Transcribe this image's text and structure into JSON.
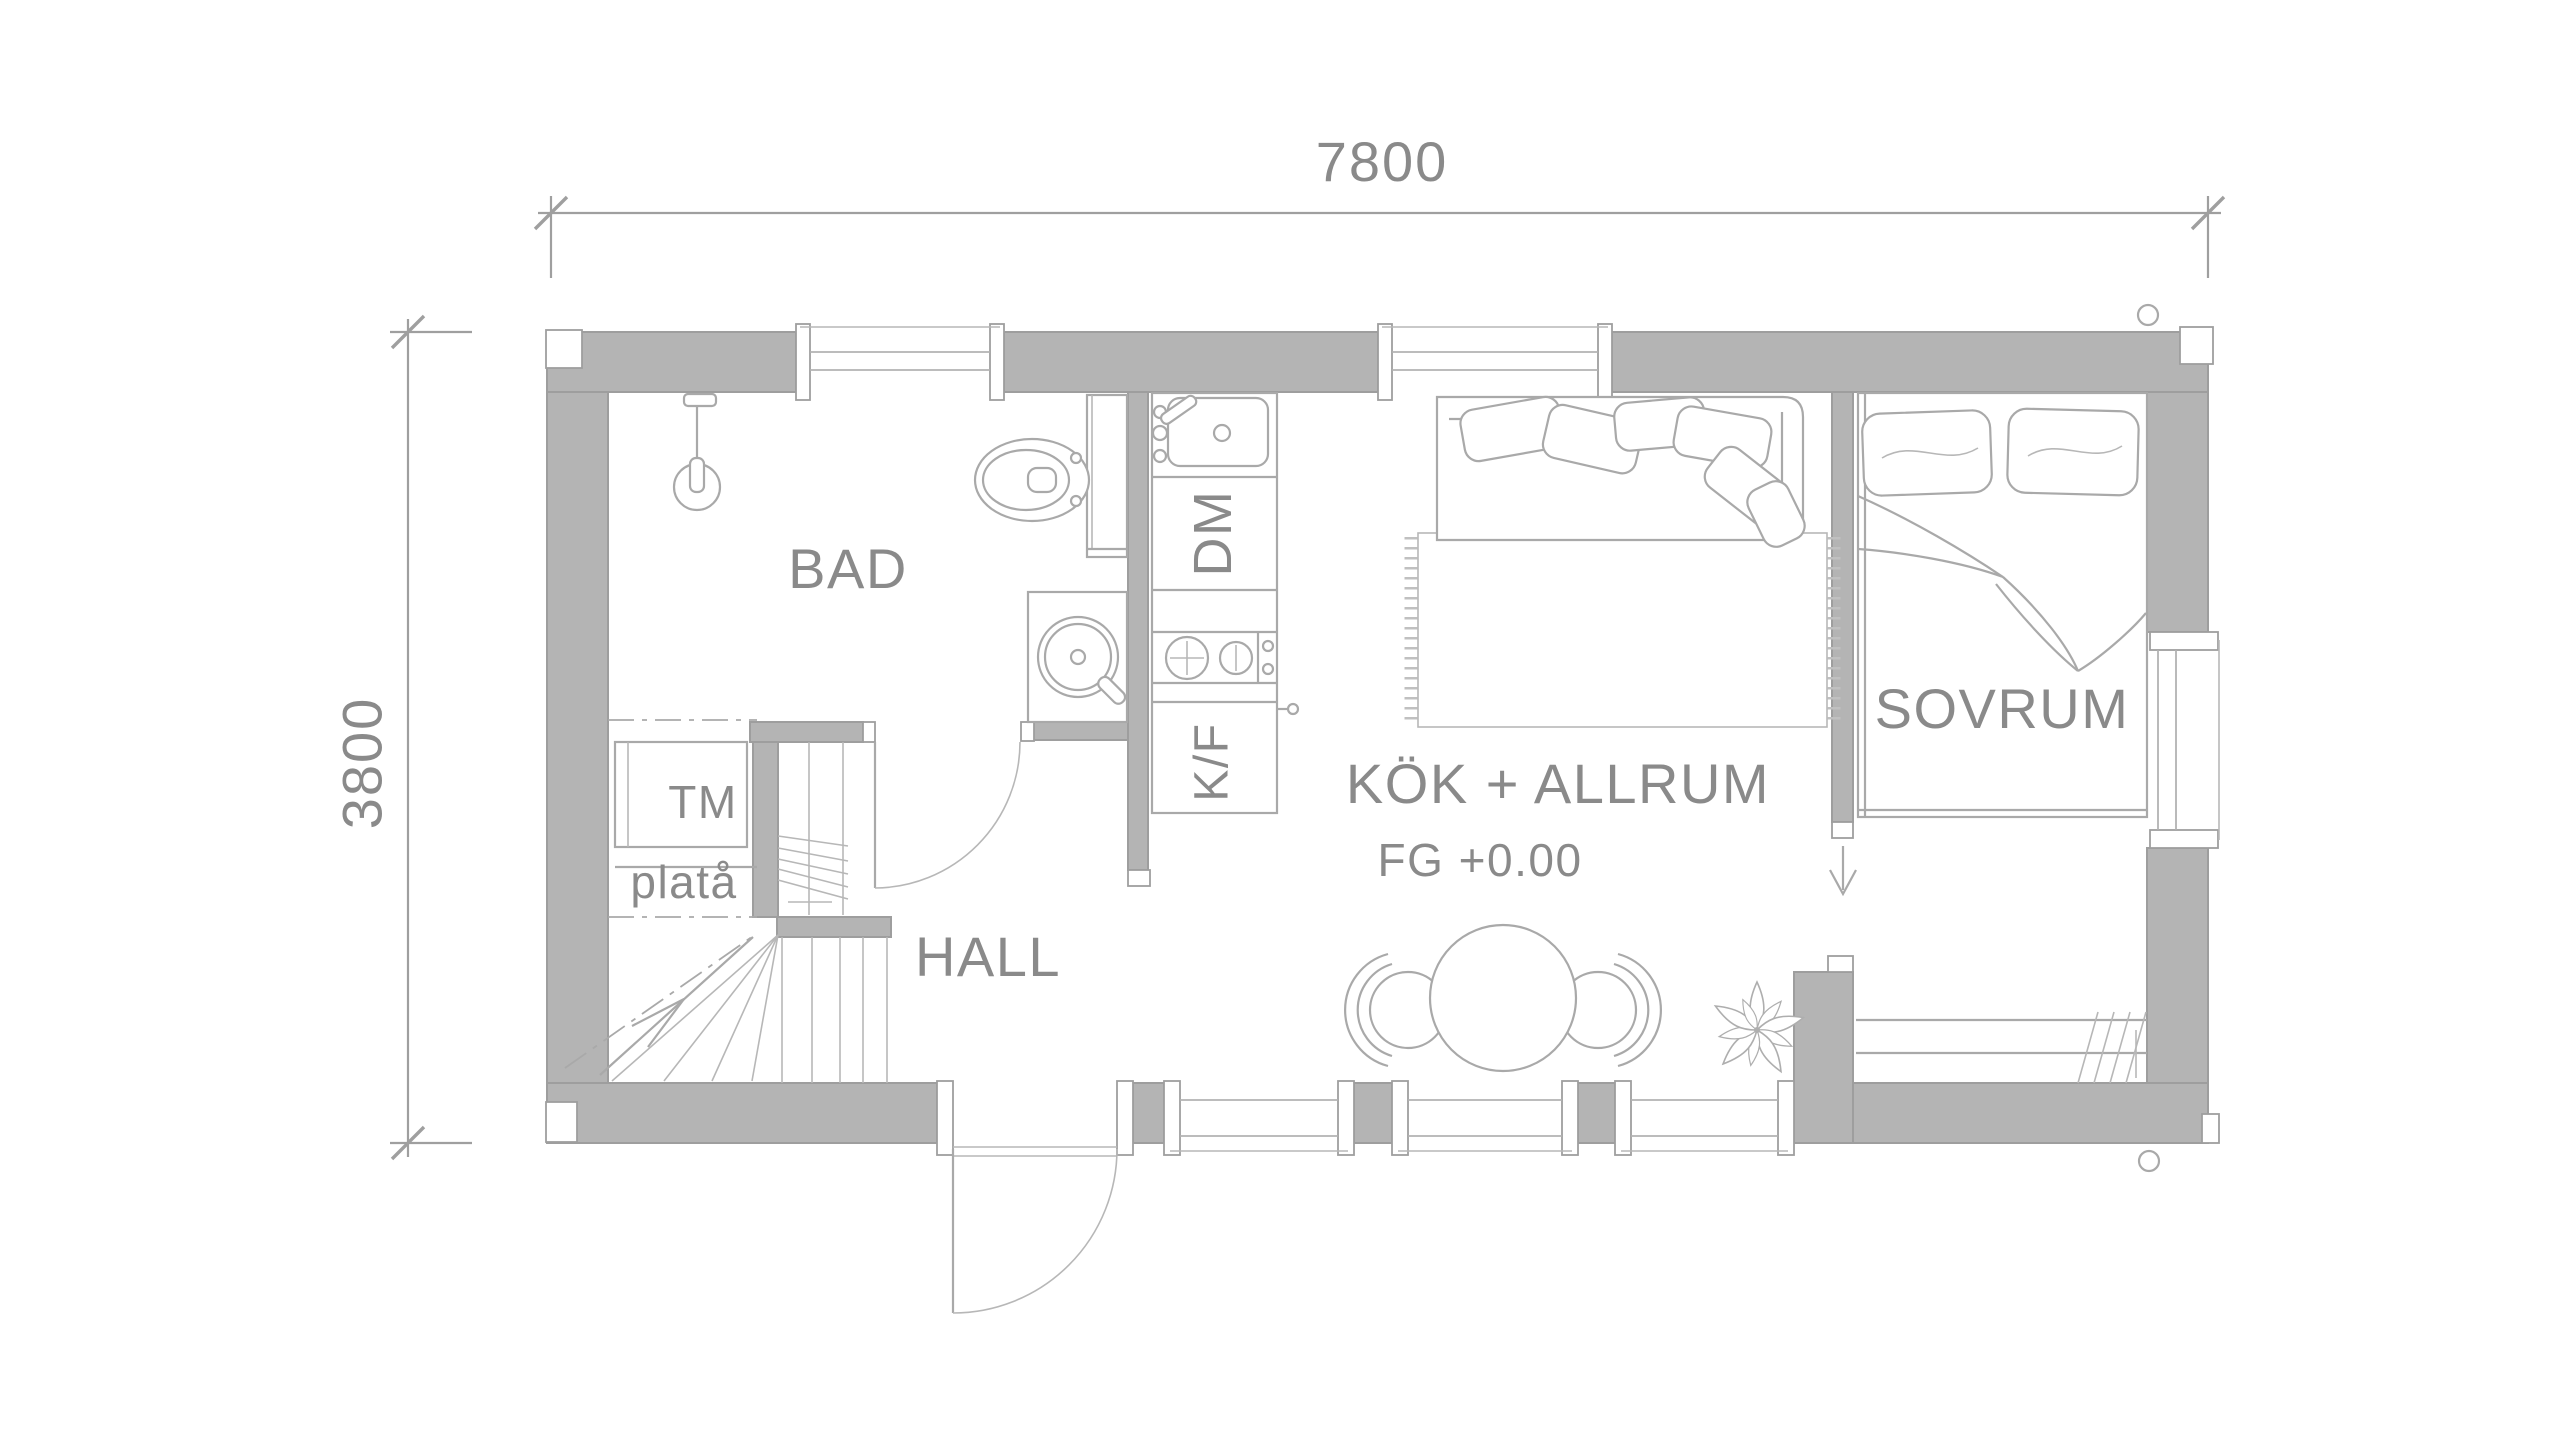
{
  "title": "Floor plan 7800 x 3800",
  "dimensions": {
    "width_mm": "7800",
    "height_mm": "3800"
  },
  "labels": {
    "bathroom": "BAD",
    "hall": "HALL",
    "kitchen_living": "KÖK + ALLRUM",
    "floor_level": "FG +0.00",
    "bedroom": "SOVRUM",
    "washing_machine": "TM",
    "platform": "platå",
    "dishwasher": "DM",
    "fridge_freezer": "K/F"
  },
  "colors": {
    "background": "#ffffff",
    "wall_fill": "#b4b4b4",
    "wall_edge": "#9e9e9e",
    "furniture_line": "#a9a9a9",
    "dimension_line": "#9f9f9f",
    "text": "#8a8a8a"
  }
}
